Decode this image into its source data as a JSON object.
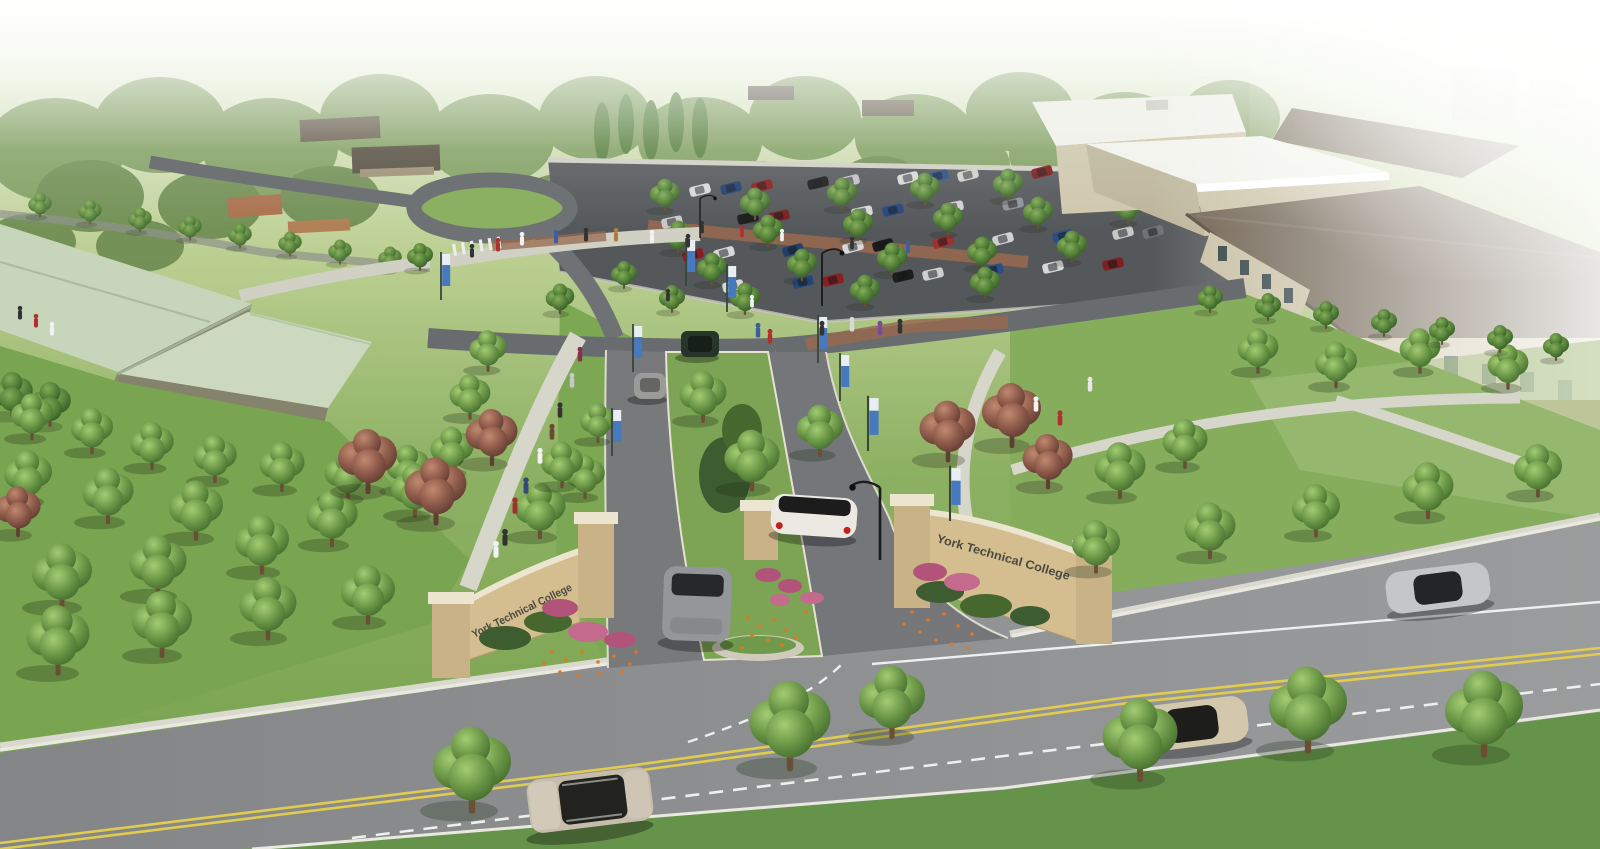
{
  "scene": {
    "title": "Aerial architectural rendering of a college campus entrance",
    "subject": "York Technical College",
    "description": "Bird's-eye rendering: tree-lined boulevard, landscaped entrance drive with brick monument signs, parking lot full of cars, sage-green-roof building left, stone campus buildings right"
  },
  "signs": {
    "left": {
      "text": "York Technical College"
    },
    "right": {
      "text": "York Technical College"
    }
  },
  "palette": {
    "lawn": "#7fa855",
    "asphalt_main_road": "#8f9193",
    "asphalt_drive": "#77797b",
    "parking_asphalt": "#55585b",
    "walkway_concrete": "#d6d6ca",
    "sign_brick": "#d4bd8f",
    "sign_cap": "#ece5d0",
    "roof_green": "#c7d6ba",
    "roof_brown": "#6e6150",
    "building_stone": "#cbc2a6",
    "banner_blue": "#4679bd",
    "centerline_yellow": "#e0cc4e",
    "flower_orange": "#e4761f",
    "flower_magenta": "#b2537a"
  }
}
